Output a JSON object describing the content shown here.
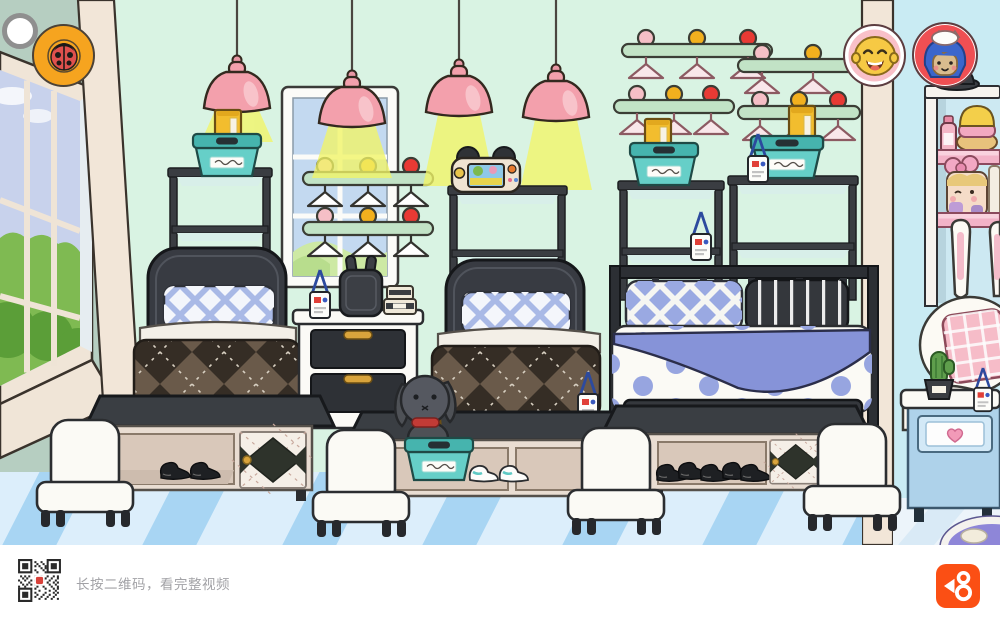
{
  "ui": {
    "camera_button_icon": "camera-shutter-icon",
    "pet_button_icon": "ladybug-icon",
    "avatar_button_1_icon": "laughing-bald-character-icon",
    "avatar_button_2_icon": "blue-hair-cat-hat-character-icon"
  },
  "bottom_bar": {
    "caption": "长按二维码，看完整视频",
    "qr_icon": "qr-code",
    "brand_icon": "kuaishou-logo",
    "brand_color": "#fb4f14"
  },
  "palette": {
    "wall_main": "#d9f3e3",
    "wall_left": "#b6cec1",
    "wall_right": "#c9ebf3",
    "trim": "#f2e6d8",
    "floor": "#dceefb",
    "floor_stripe": "#a8d5f3",
    "lamp_pink": "#f3a0ac",
    "basket_teal": "#66cfc8",
    "accent_yellow": "#f2bd2e",
    "furniture_dark": "#3a3d42"
  },
  "scene_objects": [
    "pendant-lamp",
    "pendant-lamp",
    "pendant-lamp",
    "pendant-lamp",
    "left-window",
    "middle-window",
    "hanger-rail",
    "hangers",
    "storage-basket",
    "yellow-book",
    "game-console",
    "bunny-plush",
    "bunny-phone",
    "single-bed",
    "single-bed",
    "double-bed",
    "storage-bench",
    "white-chair",
    "nightstand",
    "cosmetics-shelf",
    "bunny-bed",
    "blue-nightstand",
    "cactus",
    "badge-lanyard",
    "black-shoes",
    "white-sneakers",
    "purple-rug"
  ]
}
